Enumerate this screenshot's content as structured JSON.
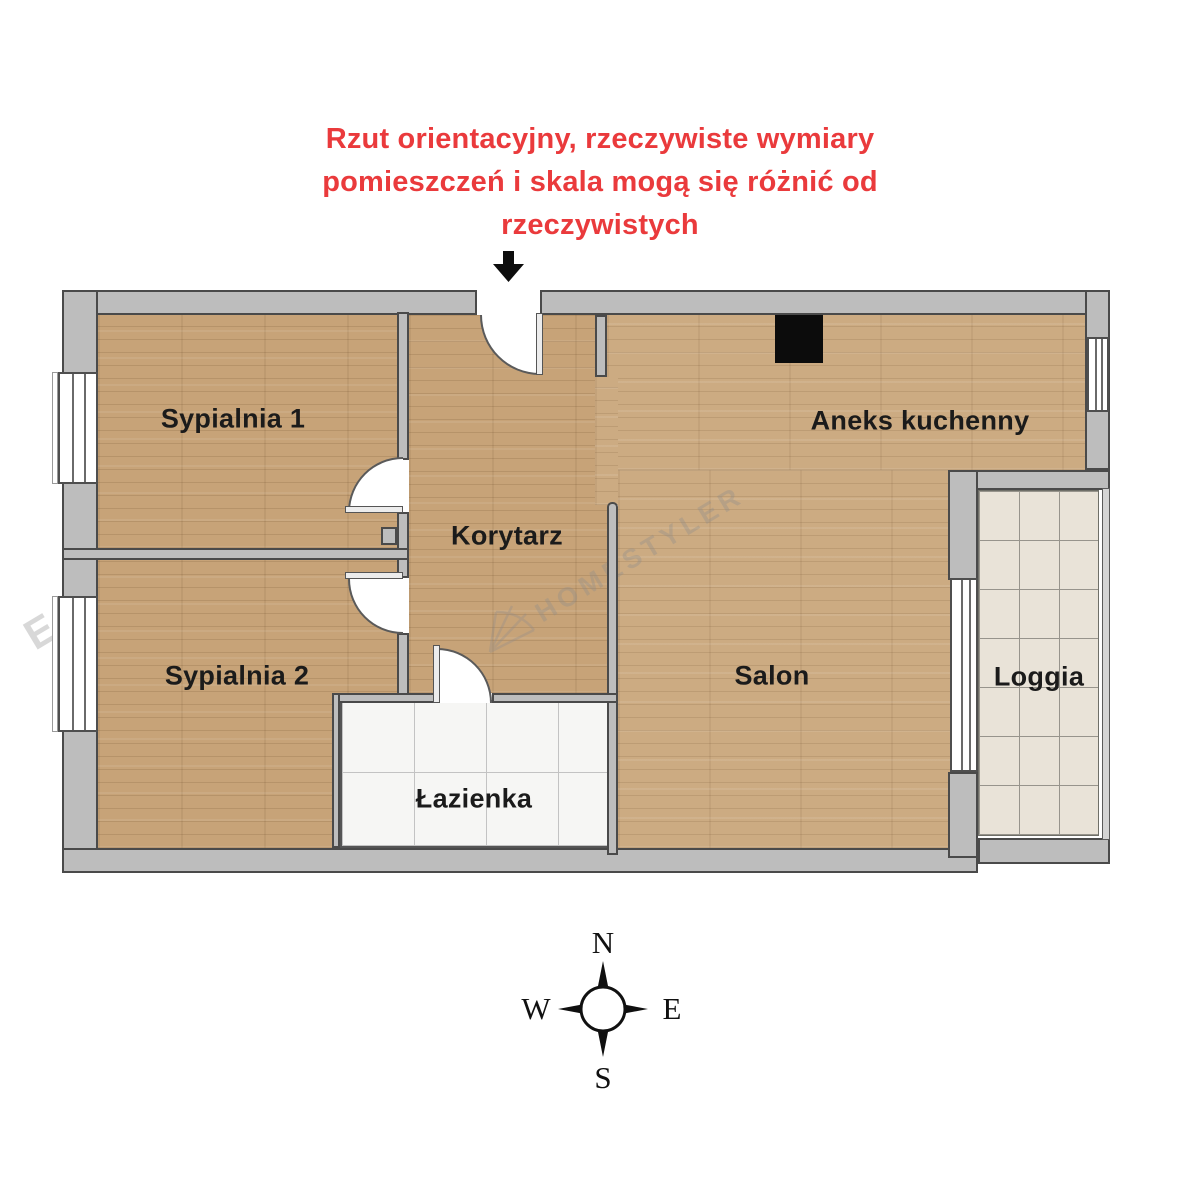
{
  "disclaimer": {
    "lines": [
      "Rzut orientacyjny, rzeczywiste wymiary",
      "pomieszczeń i skala mogą się różnić od",
      "rzeczywistych"
    ],
    "color": "#ea3a3c"
  },
  "plan": {
    "rooms": {
      "sypialnia1": "Sypialnia 1",
      "sypialnia2": "Sypialnia 2",
      "korytarz": "Korytarz",
      "aneks_kuchenny": "Aneks kuchenny",
      "salon": "Salon",
      "lazienka": "Łazienka",
      "loggia": "Loggia"
    }
  },
  "compass": {
    "north": "N",
    "east": "E",
    "south": "S",
    "west": "W"
  },
  "watermark": {
    "main": "HOMESTYLER",
    "partial": "ER"
  },
  "colors": {
    "wall_fill": "#bdbdbd",
    "wall_outline": "#4a4a4a",
    "wood": "#c7a378",
    "wood_light": "#ccab82",
    "bath_tile": "#f6f6f4",
    "loggia_tile": "#e9e3d8",
    "appliance": "#0c0c0c",
    "red": "#ea3a3c",
    "watermark": "#8c8c8c"
  }
}
